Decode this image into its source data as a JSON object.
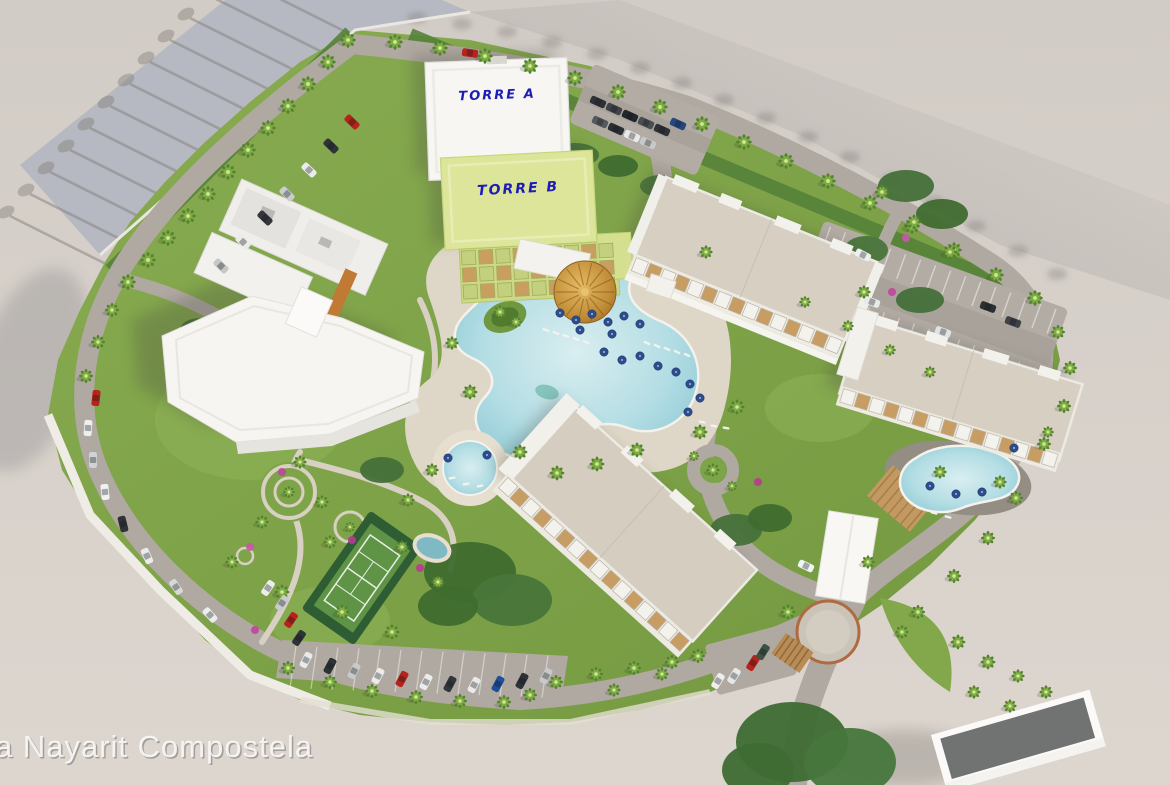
{
  "title": "Resort master plan aerial render",
  "watermark": "a Nayarit Compostela",
  "labels": {
    "torre_a": "TORRE A",
    "torre_b": "TORRE B"
  },
  "palette": {
    "outside_ground": "#d6cfc8",
    "outer_road_band": "#b6b9c1",
    "lawn": "#7ea449",
    "lawn_dark": "#4d7631",
    "road": "#b0a9a1",
    "walkway": "#d8d0c2",
    "pool_water_light": "#d4e9eb",
    "pool_water_deep": "#8cc8d4",
    "pool_deck": "#ded6c6",
    "building_white": "#f6f5f2",
    "roof_beige": "#d6cfc2",
    "torre_b_green": "#dce599",
    "terrace_wood": "#c79d63",
    "palapa_gold": "#c9953f",
    "label_blue": "#1d1db5",
    "tennis_green": "#5f9446",
    "car_red": "#b8221c",
    "umbrella_blue": "#2d4d8f",
    "accent_orange": "#c07a33"
  },
  "scene": {
    "features": [
      "torre-a-building",
      "torre-b-building",
      "west-hotel-building",
      "northeast-condo-building",
      "east-condo-building",
      "south-condo-building",
      "main-lagoon-pool",
      "palapa-dome",
      "east-pool",
      "round-pool",
      "tennis-court",
      "entrance-canopy",
      "entrance-roundabout",
      "parking-lots",
      "palm-tree-rows",
      "perimeter-road"
    ]
  }
}
